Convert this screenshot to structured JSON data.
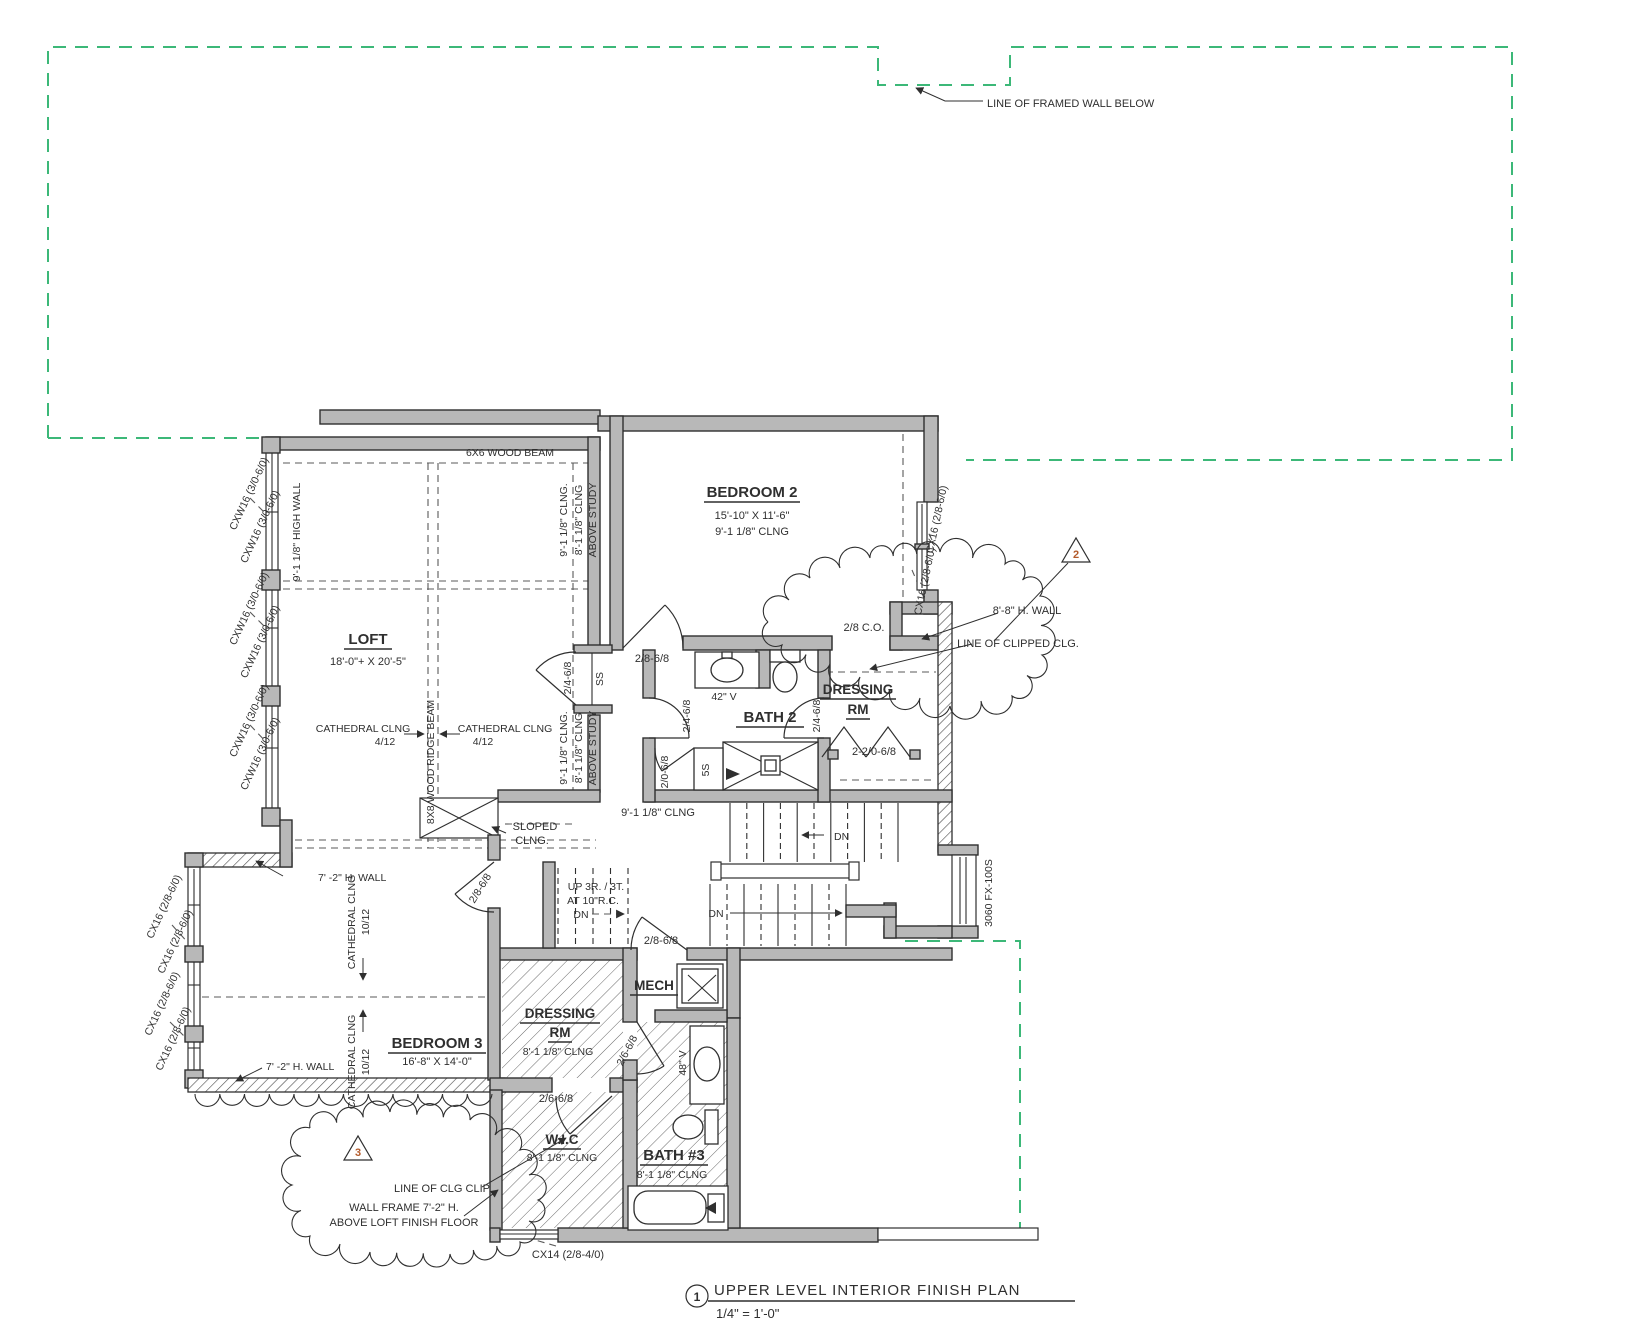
{
  "colors": {
    "green_dash": "#3cb878",
    "wall_fill": "#b8b8b8",
    "line": "#2f2f2f",
    "callout_number": "#b35a2a"
  },
  "titleblock": {
    "number": "1",
    "heading": "UPPER LEVEL INTERIOR FINISH PLAN",
    "scale": "1/4\" = 1'-0\""
  },
  "rooms": {
    "loft": {
      "name": "LOFT",
      "dims": "18'-0\"+ X 20'-5\""
    },
    "bedroom2": {
      "name": "BEDROOM 2",
      "dims": "15'-10\" X 11'-6\"",
      "ceiling": "9'-1 1/8\" CLNG"
    },
    "bath2": {
      "name": "BATH 2"
    },
    "dressing_top": {
      "line1": "DRESSING",
      "line2": "RM"
    },
    "bedroom3": {
      "name": "BEDROOM 3",
      "dims": "16'-8\" X 14'-0\""
    },
    "dressing_bottom": {
      "line1": "DRESSING",
      "line2": "RM",
      "ceiling": "8'-1 1/8\" CLNG"
    },
    "mech": {
      "name": "MECH"
    },
    "wic": {
      "name": "W.I.C",
      "ceiling": "8'-1 1/8\" CLNG"
    },
    "bath3": {
      "name": "BATH #3",
      "ceiling": "8'-1 1/8\" CLNG"
    }
  },
  "notes": {
    "framed_wall": "LINE OF FRAMED WALL BELOW",
    "wood_beam": "6X6 WOOD BEAM",
    "ridge_beam": "8X8 WOOD RIDGE BEAM",
    "high_wall": "9'-1 1/8\" HIGH WALL",
    "clng_911": "9'-1 1/8\" CLNG.",
    "clng_811": "8'-1 1/8\" CLNG",
    "above_study": "ABOVE STUDY",
    "cathedral": "CATHEDRAL CLNG",
    "pitch_412": "4/12",
    "pitch_1012": "10/12",
    "clng_911_hall": "9'-1 1/8\" CLNG",
    "sloped_1": "SLOPED",
    "sloped_2": "CLNG.",
    "clipped_clg": "LINE OF CLIPPED CLG.",
    "h_wall_88": "8'-8\" H. WALL",
    "h_wall_72": "7' -2\" H. WALL",
    "up_stair_1": "UP 3R. / 3T.",
    "up_stair_2": "AT 10\"R.C.",
    "dn": "DN",
    "clg_clip": "LINE OF CLG CLIP",
    "wall_frame_1": "WALL FRAME 7'-2\" H.",
    "wall_frame_2": "ABOVE LOFT FINISH FLOOR",
    "vanity_42": "42\" V",
    "vanity_48": "48\" V",
    "shelf_5s": "5S",
    "shelf_ss": "SS"
  },
  "openings": {
    "d_2868": "2/8-6/8",
    "d_2468": "2/4-6/8",
    "d_2068": "2/0-6/8",
    "d_22068": "2-2/0-6/8",
    "d_2668": "2/6-6/8",
    "co_28": "2/8 C.O.",
    "w_cxw16": "CXW16 (3/0-6/0)",
    "w_cx16": "CX16 (2/8-6/0)",
    "w_cx14": "CX14 (2/8-4/0)",
    "w_3060": "3060 FX-100S"
  },
  "callouts": {
    "c2": "2",
    "c3": "3"
  }
}
